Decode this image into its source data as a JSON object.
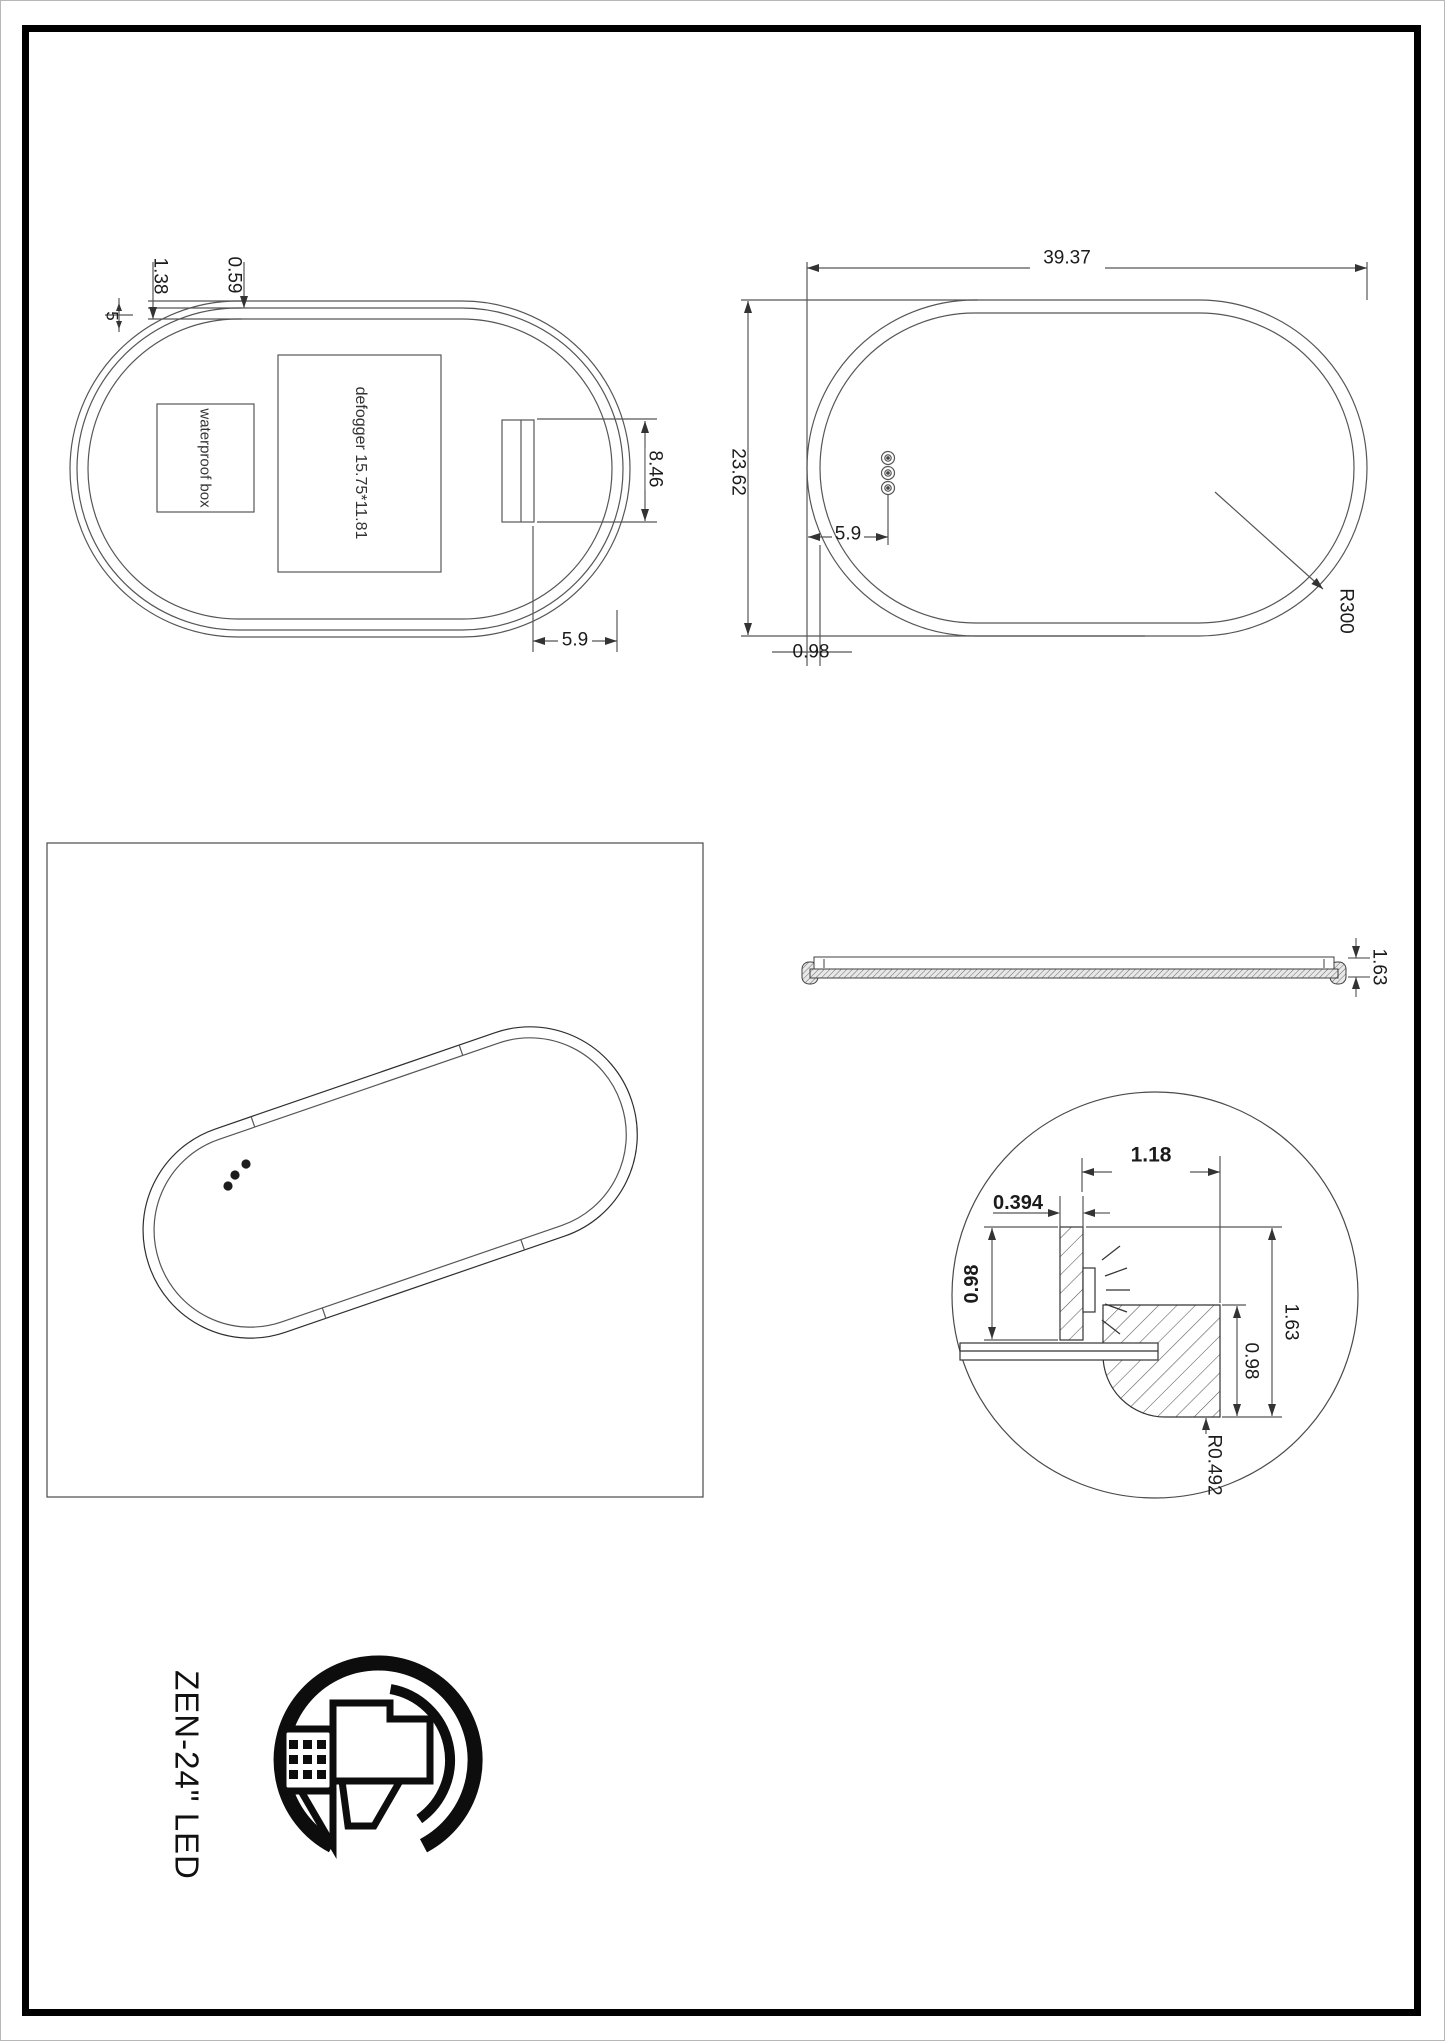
{
  "product": {
    "name": "ZEN-24\" LED"
  },
  "colors": {
    "page_border": "#000000",
    "line": "#565656",
    "text": "#1b1b1b"
  },
  "rear_view": {
    "defogger_label": "defogger 15.75*11.81",
    "waterproof_label": "waterproof box",
    "dims": {
      "edge_gap": "5",
      "frame_depth": "1.38",
      "frame_lip": "0.59",
      "bracket_height": "8.46",
      "bracket_inset": "5.9"
    }
  },
  "front_view": {
    "dims": {
      "width": "39.37",
      "height": "23.62",
      "sensor_inset": "5.9",
      "edge_width": "0.98",
      "corner_radius": "R300"
    }
  },
  "side_view": {
    "dims": {
      "thickness": "1.63"
    }
  },
  "detail_view": {
    "dims": {
      "channel_span": "1.18",
      "led_width": "0.394",
      "led_height": "0.98",
      "total_depth": "1.63",
      "profile_depth": "0.98",
      "fillet_radius": "R0.492"
    }
  }
}
